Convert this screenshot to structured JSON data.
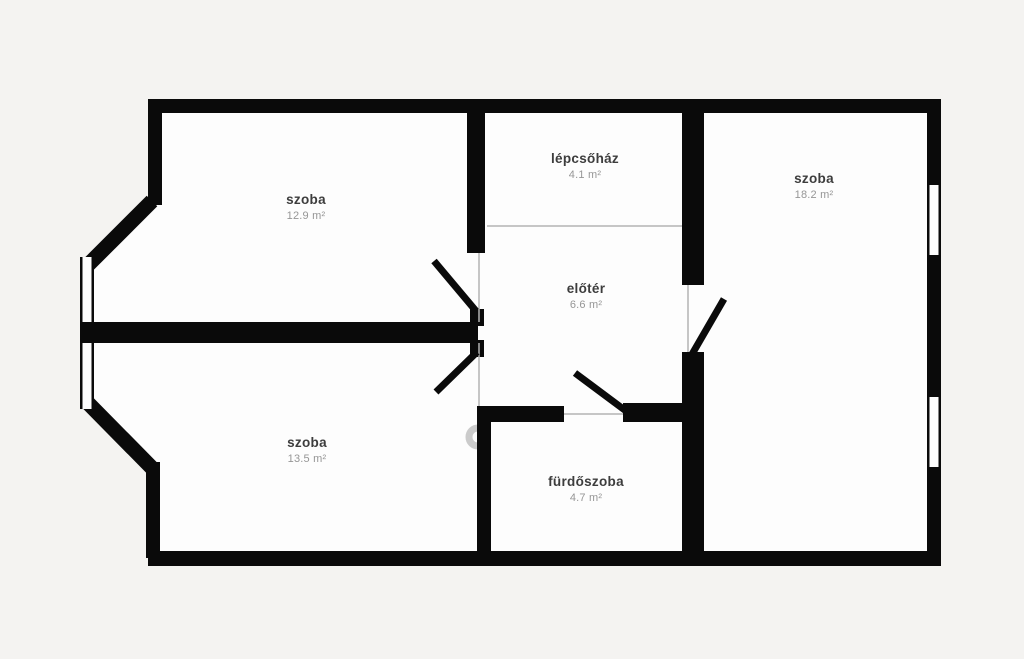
{
  "plan": {
    "type": "floor-plan",
    "language": "hu",
    "rooms": [
      {
        "id": "room-top-left",
        "name": "szoba",
        "area": "12.9 m²"
      },
      {
        "id": "staircase",
        "name": "lépcsőház",
        "area": "4.1 m²"
      },
      {
        "id": "room-right",
        "name": "szoba",
        "area": "18.2 m²"
      },
      {
        "id": "foyer",
        "name": "előtér",
        "area": "6.6 m²"
      },
      {
        "id": "room-bottom-left",
        "name": "szoba",
        "area": "13.5 m²"
      },
      {
        "id": "bathroom",
        "name": "fürdőszoba",
        "area": "4.7 m²"
      }
    ],
    "colors": {
      "background": "#f4f3f1",
      "floor": "#fdfdfd",
      "wall": "#0a0a0a",
      "thin_line": "#b3b3b3",
      "label": "#3d3d3d",
      "area_label": "#969696"
    }
  }
}
